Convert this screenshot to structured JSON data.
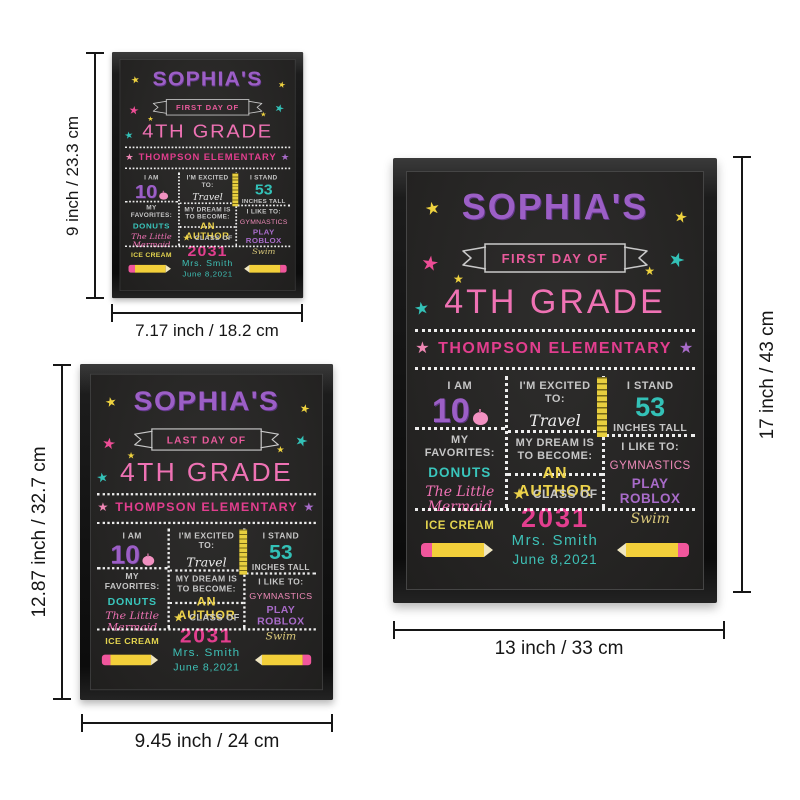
{
  "signs": [
    {
      "size_name": "small",
      "banner_label": "FIRST DAY OF",
      "height_label": "9 inch / 23.3 cm",
      "width_label": "7.17 inch / 18.2 cm"
    },
    {
      "size_name": "medium",
      "banner_label": "LAST DAY OF",
      "height_label": "12.87 inch / 32.7 cm",
      "width_label": "9.45 inch / 24 cm"
    },
    {
      "size_name": "large",
      "banner_label": "FIRST DAY OF",
      "height_label": "17 inch / 43 cm",
      "width_label": "13 inch / 33 cm"
    }
  ],
  "board": {
    "name": "SOPHIA'S",
    "grade": "4TH GRADE",
    "school": "THOMPSON ELEMENTARY",
    "star_glyph": "★",
    "age_label": "I AM",
    "age_value": "10",
    "excited_label": "I'M EXCITED TO:",
    "excited_value": "Travel",
    "stand_label": "I STAND",
    "stand_value": "53",
    "stand_unit": "INCHES TALL",
    "favorites_label": "MY FAVORITES:",
    "favorite_1": "DONUTS",
    "favorite_2": "The Little Mermaid",
    "favorite_3": "ICE CREAM",
    "dream_label": "MY DREAM IS TO BECOME:",
    "dream_value": "AN AUTHOR",
    "class_label": "CLASS OF",
    "class_value": "2031",
    "likes_label": "I LIKE TO:",
    "like_1": "GYMNASTICS",
    "like_2": "PLAY ROBLOX",
    "like_3": "Swim",
    "teacher": "Mrs. Smith",
    "date": "June 8,2021"
  },
  "colors": {
    "purple": "#9c5fc6",
    "pink": "#ef72b4",
    "magenta": "#e23e8e",
    "teal": "#33c1b7",
    "yellow": "#eed23f",
    "light_pink": "#ee8ab8",
    "chalk_gray": "#c6c6c6",
    "board_bg": "#262524",
    "frame_black": "#161616"
  }
}
